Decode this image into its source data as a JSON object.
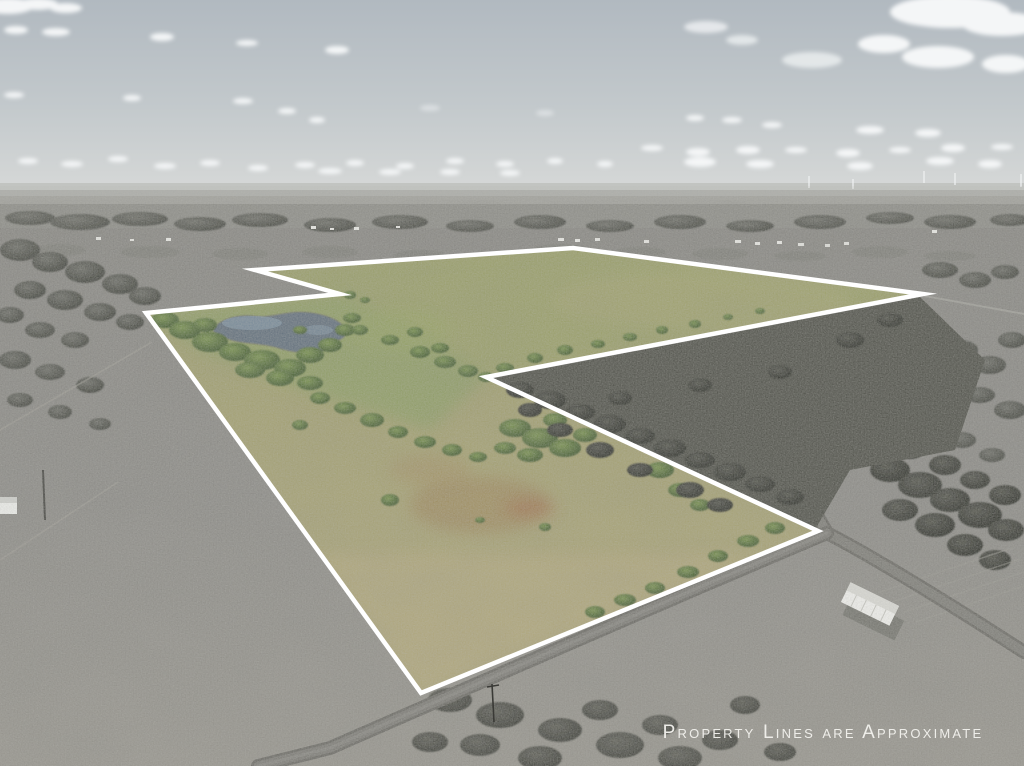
{
  "annotation": {
    "caption": "Property Lines are Approximate"
  },
  "scene": {
    "type": "aerial-drone-photo",
    "subject": "rural land parcel outlined in white; parcel shown in color while surrounding land is desaturated gray",
    "features": [
      "pond inside parcel",
      "scattered green trees inside parcel",
      "open olive pasture (upper field) and tan grass strip",
      "gravel road junction at the parcel's east corner",
      "white mobile home in gray field east of parcel",
      "wind turbines on the hazy horizon",
      "scattered white clouds in pale sky"
    ]
  },
  "palette": {
    "boundary_line": "#ffffff",
    "caption_text": "#f2f1ed",
    "pasture_olive": "#9fa06c",
    "pasture_tan": "#b0a77d",
    "tree_green": "#4c6539",
    "pond_water": "#66737f",
    "surroundings_gray": "#8c8b87",
    "sky": "#bcc3c8",
    "road_gray": "#7e7d78"
  }
}
